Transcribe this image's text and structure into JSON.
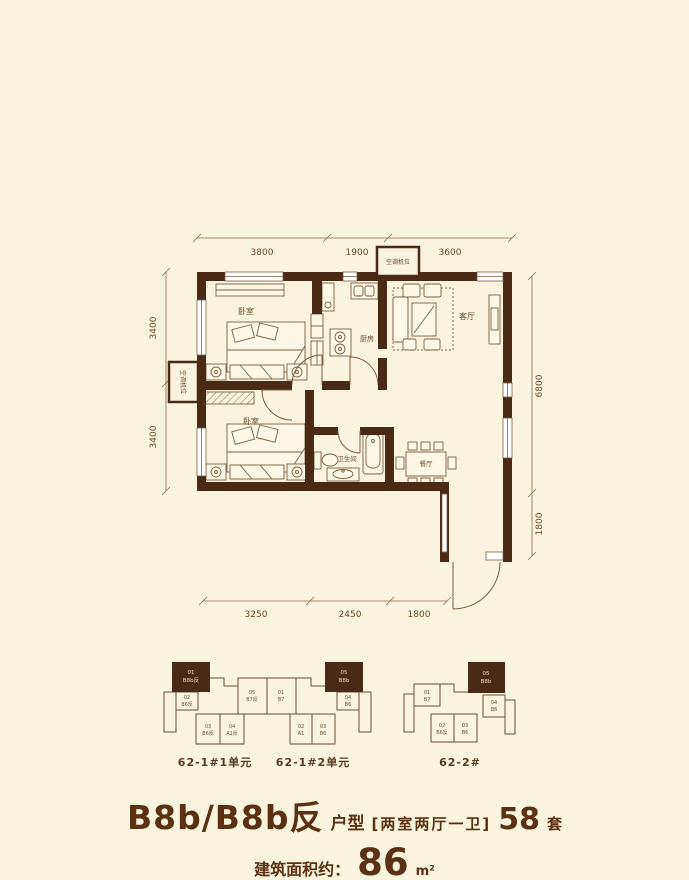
{
  "page": {
    "colors": {
      "background": "#faf3dd",
      "wall": "#4a2a14",
      "thin_line": "#7d5d3f",
      "dimension": "#6a482a",
      "title_text": "#5a3113",
      "highlight_unit_text": "#ecdcc2"
    }
  },
  "floorplan": {
    "rooms": {
      "bedroom1": "卧室",
      "bedroom2": "卧室",
      "kitchen": "厨房",
      "living": "客厅",
      "dining": "餐厅",
      "bathroom": "卫生间",
      "ac_top": "空调机位",
      "ac_left": "空调机位"
    },
    "dims": {
      "top": [
        "3800",
        "1900",
        "3600"
      ],
      "left": [
        "3400",
        "3400"
      ],
      "right": [
        "6800",
        "1800"
      ],
      "bottom": [
        "3250",
        "2450",
        "1800"
      ]
    }
  },
  "building_keys": [
    {
      "caption": "62-1#1单元",
      "units": [
        {
          "id": "01",
          "type": "B8b反",
          "highlight": true
        },
        {
          "id": "02",
          "type": "B6反"
        },
        {
          "id": "03",
          "type": "B6反"
        },
        {
          "id": "04",
          "type": "A1反"
        },
        {
          "id": "05",
          "type": "B7反"
        }
      ]
    },
    {
      "caption": "62-1#2单元",
      "units": [
        {
          "id": "01",
          "type": "B7"
        },
        {
          "id": "02",
          "type": "A1"
        },
        {
          "id": "03",
          "type": "B6"
        },
        {
          "id": "04",
          "type": "B6"
        },
        {
          "id": "05",
          "type": "B8b",
          "highlight": true
        }
      ]
    },
    {
      "caption": "62-2#",
      "units": [
        {
          "id": "01",
          "type": "B7"
        },
        {
          "id": "02",
          "type": "B6反"
        },
        {
          "id": "03",
          "type": "B6"
        },
        {
          "id": "04",
          "type": "B6"
        },
        {
          "id": "05",
          "type": "B8b",
          "highlight": true
        }
      ]
    }
  ],
  "title": {
    "model": "B8b/B8b反",
    "model_suffix": "户型",
    "layout": "[两室两厅一卫]",
    "count": "58",
    "count_unit": "套",
    "area_label": "建筑面积约：",
    "area_value": "86",
    "area_unit": "m²"
  }
}
